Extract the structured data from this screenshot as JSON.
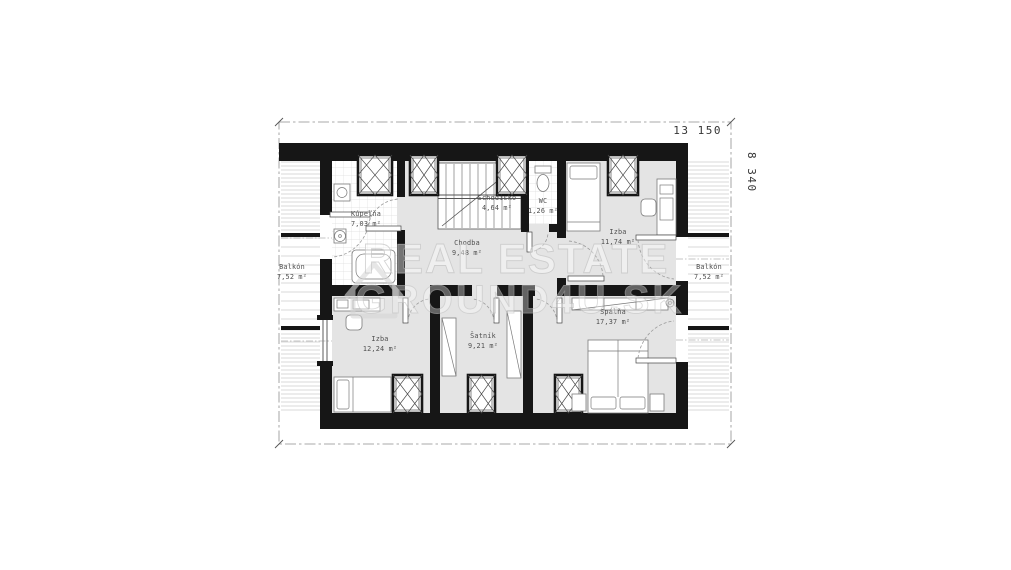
{
  "plan": {
    "dimension_width": "13 150",
    "dimension_height": "8 340",
    "rooms": [
      {
        "name": "Kúpeľňa",
        "area": "7,03 m²"
      },
      {
        "name": "Schodisko",
        "area": "4,64 m²"
      },
      {
        "name": "WC",
        "area": "1,26 m²"
      },
      {
        "name": "Chodba",
        "area": "9,48 m²"
      },
      {
        "name": "Izba",
        "area": "11,74 m²"
      },
      {
        "name": "Izba",
        "area": "12,24 m²"
      },
      {
        "name": "Šatník",
        "area": "9,21 m²"
      },
      {
        "name": "Spálňa",
        "area": "17,37 m²"
      },
      {
        "name": "Balkón",
        "area": "7,52 m²"
      },
      {
        "name": "Balkón",
        "area": "7,52 m²"
      }
    ],
    "watermark": {
      "line1": "REAL ESTATE",
      "line2": "GROUND4U.SK"
    },
    "colors": {
      "wall": "#161616",
      "floor_gray": "#e4e4e4",
      "hatch_line": "#c9c9c9",
      "boundary_dash": "#8f8f8f",
      "label_text": "#4f4f4f",
      "dimension_text": "#353535",
      "watermark_gray": "#c6c6c6"
    }
  }
}
